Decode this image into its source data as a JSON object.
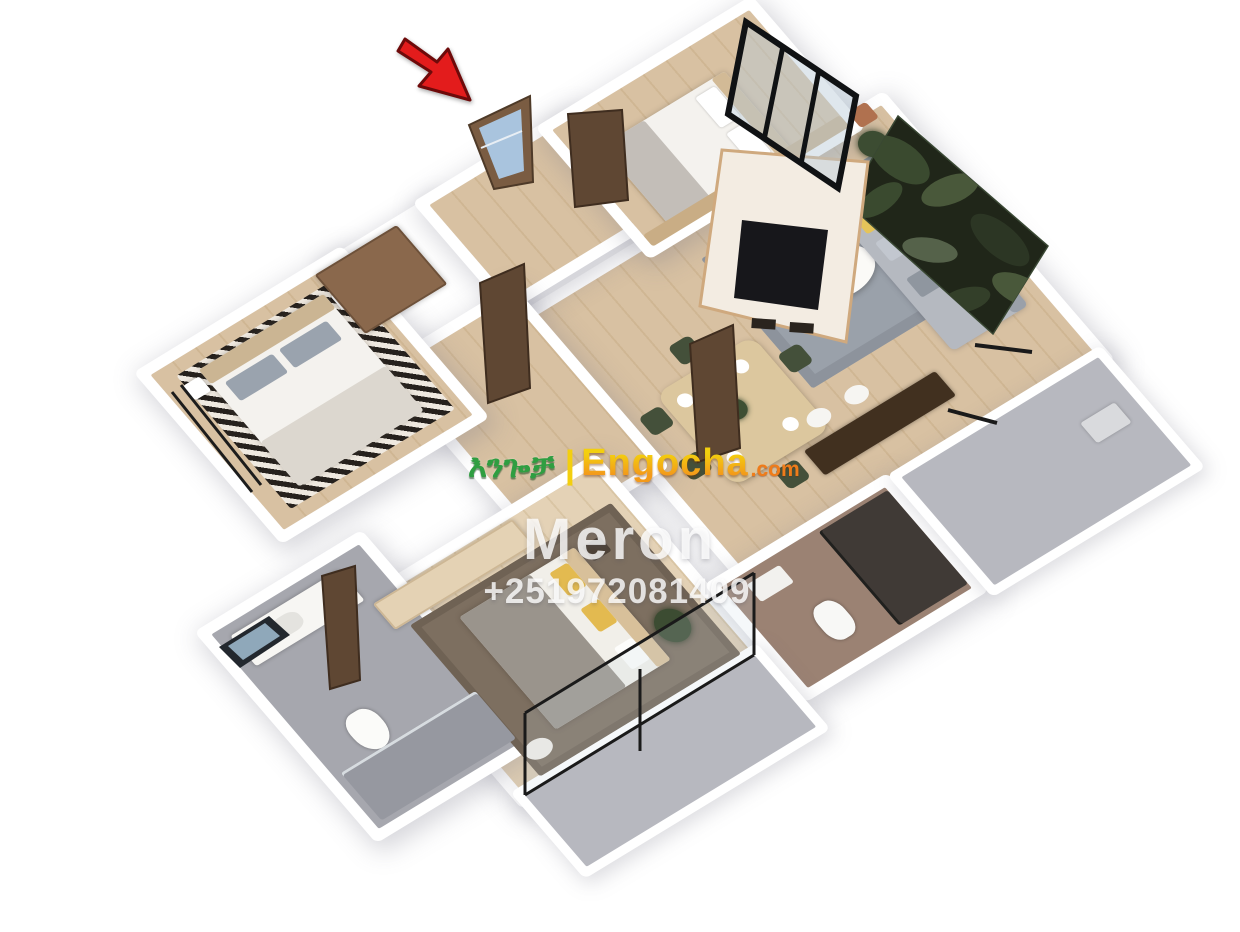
{
  "watermark": {
    "logo": {
      "amharic": "እንጐቻ",
      "separator": "|",
      "brand": "Engocha",
      "tld": ".com"
    },
    "seller_name": "Meron",
    "phone": "+251972081409"
  },
  "annotation": {
    "entrance_arrow_icon": "red-arrow-pointing-to-entrance-door"
  },
  "colors": {
    "background": "#ffffff",
    "wall_white": "#ffffff",
    "arrow_red": "#e31c1c",
    "logo_green": "#2f9e41",
    "logo_yellow": "#f3cf0e",
    "logo_orange": "#f39a1a",
    "logo_tld_orange": "#ef7c1a",
    "watermark_text": "rgba(255,255,255,0.8)",
    "wood_floor": "#d8c1a2",
    "wood_floor_light": "#e4d2b6",
    "tile_gray": "#a6a7ae",
    "balcony_gray": "#b7b8bf",
    "rug_gray": "#9aa1aa",
    "leaf_wall_dark": "#202619",
    "door_brown": "#5f4733",
    "entrance_door_brown": "#7a5c42",
    "glass_blue": "#a9c4de"
  }
}
